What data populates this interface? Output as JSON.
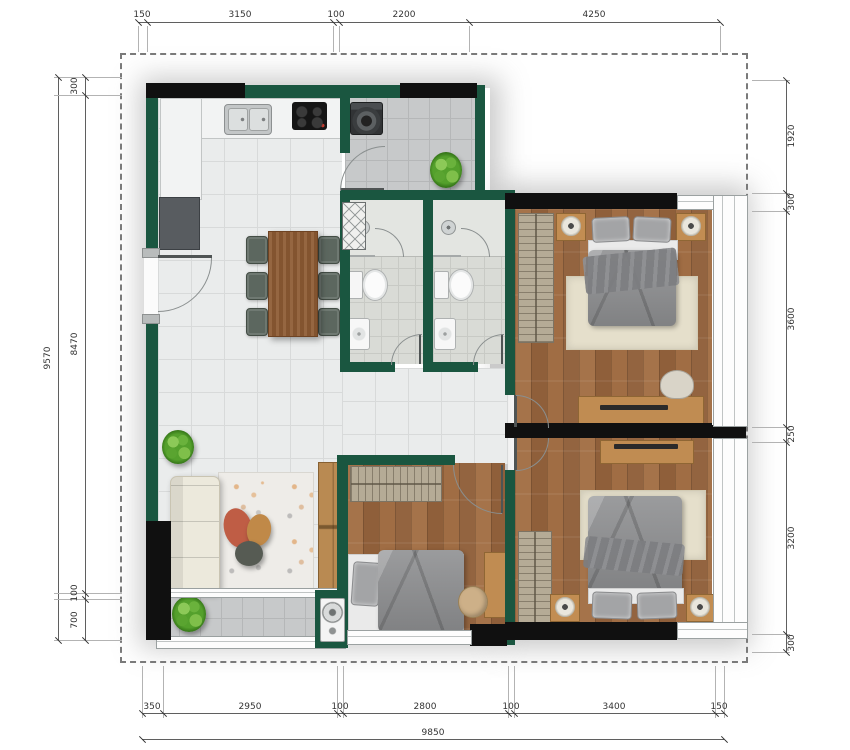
{
  "dimensions": {
    "top": [
      "150",
      "3150",
      "100",
      "2200",
      "4250"
    ],
    "bottom": [
      "350",
      "2950",
      "100",
      "2800",
      "100",
      "3400",
      "150"
    ],
    "bottom_total": "9850",
    "left": [
      "300",
      "8470",
      "100",
      "700"
    ],
    "left_total": "9570",
    "right": [
      "1920",
      "300",
      "3600",
      "250",
      "3200",
      "300"
    ]
  },
  "colors": {
    "wall_green": "#1a5640",
    "wall_black": "#101010",
    "wood_floor": "#9c6b42",
    "tile_floor": "#eaecec",
    "balcony_tile": "#c7c9ca",
    "rug_cream": "#e5dfcb",
    "accent_coral": "#bf5d45",
    "accent_tan": "#c08948",
    "plant_green": "#54a02c"
  }
}
